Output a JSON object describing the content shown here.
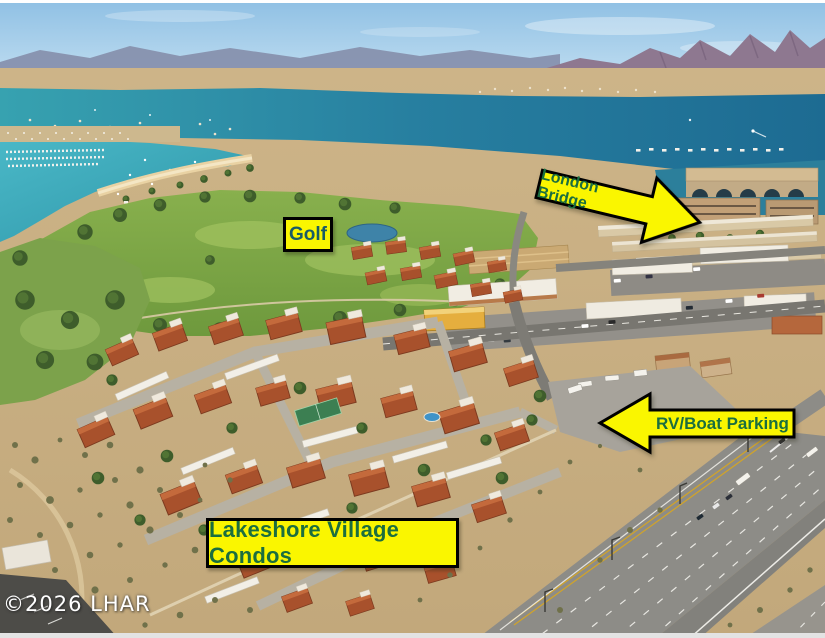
{
  "annotations": {
    "london_bridge": {
      "label": "London Bridge"
    },
    "golf": {
      "label": "Golf"
    },
    "rv_boat_parking": {
      "label": "RV/Boat Parking"
    },
    "lakeshore_condos": {
      "label": "Lakeshore Village Condos"
    },
    "watermark": {
      "label": "©2026 LHAR"
    }
  },
  "colors": {
    "annotation_background": "#FAF600",
    "annotation_border": "#000000",
    "annotation_text_green": "#1B6E3F",
    "golf_text": "#1A5C66",
    "watermark_text": "#FFFFFF",
    "lake_water": "#2A86A4",
    "marina_water": "#3FB0C0",
    "golf_grass": "#7FA746",
    "condo_roof": "#A8512C",
    "desert_sand": "#C9B184",
    "highway_asphalt": "#8D8C87",
    "sky": "#9CC8E8"
  }
}
